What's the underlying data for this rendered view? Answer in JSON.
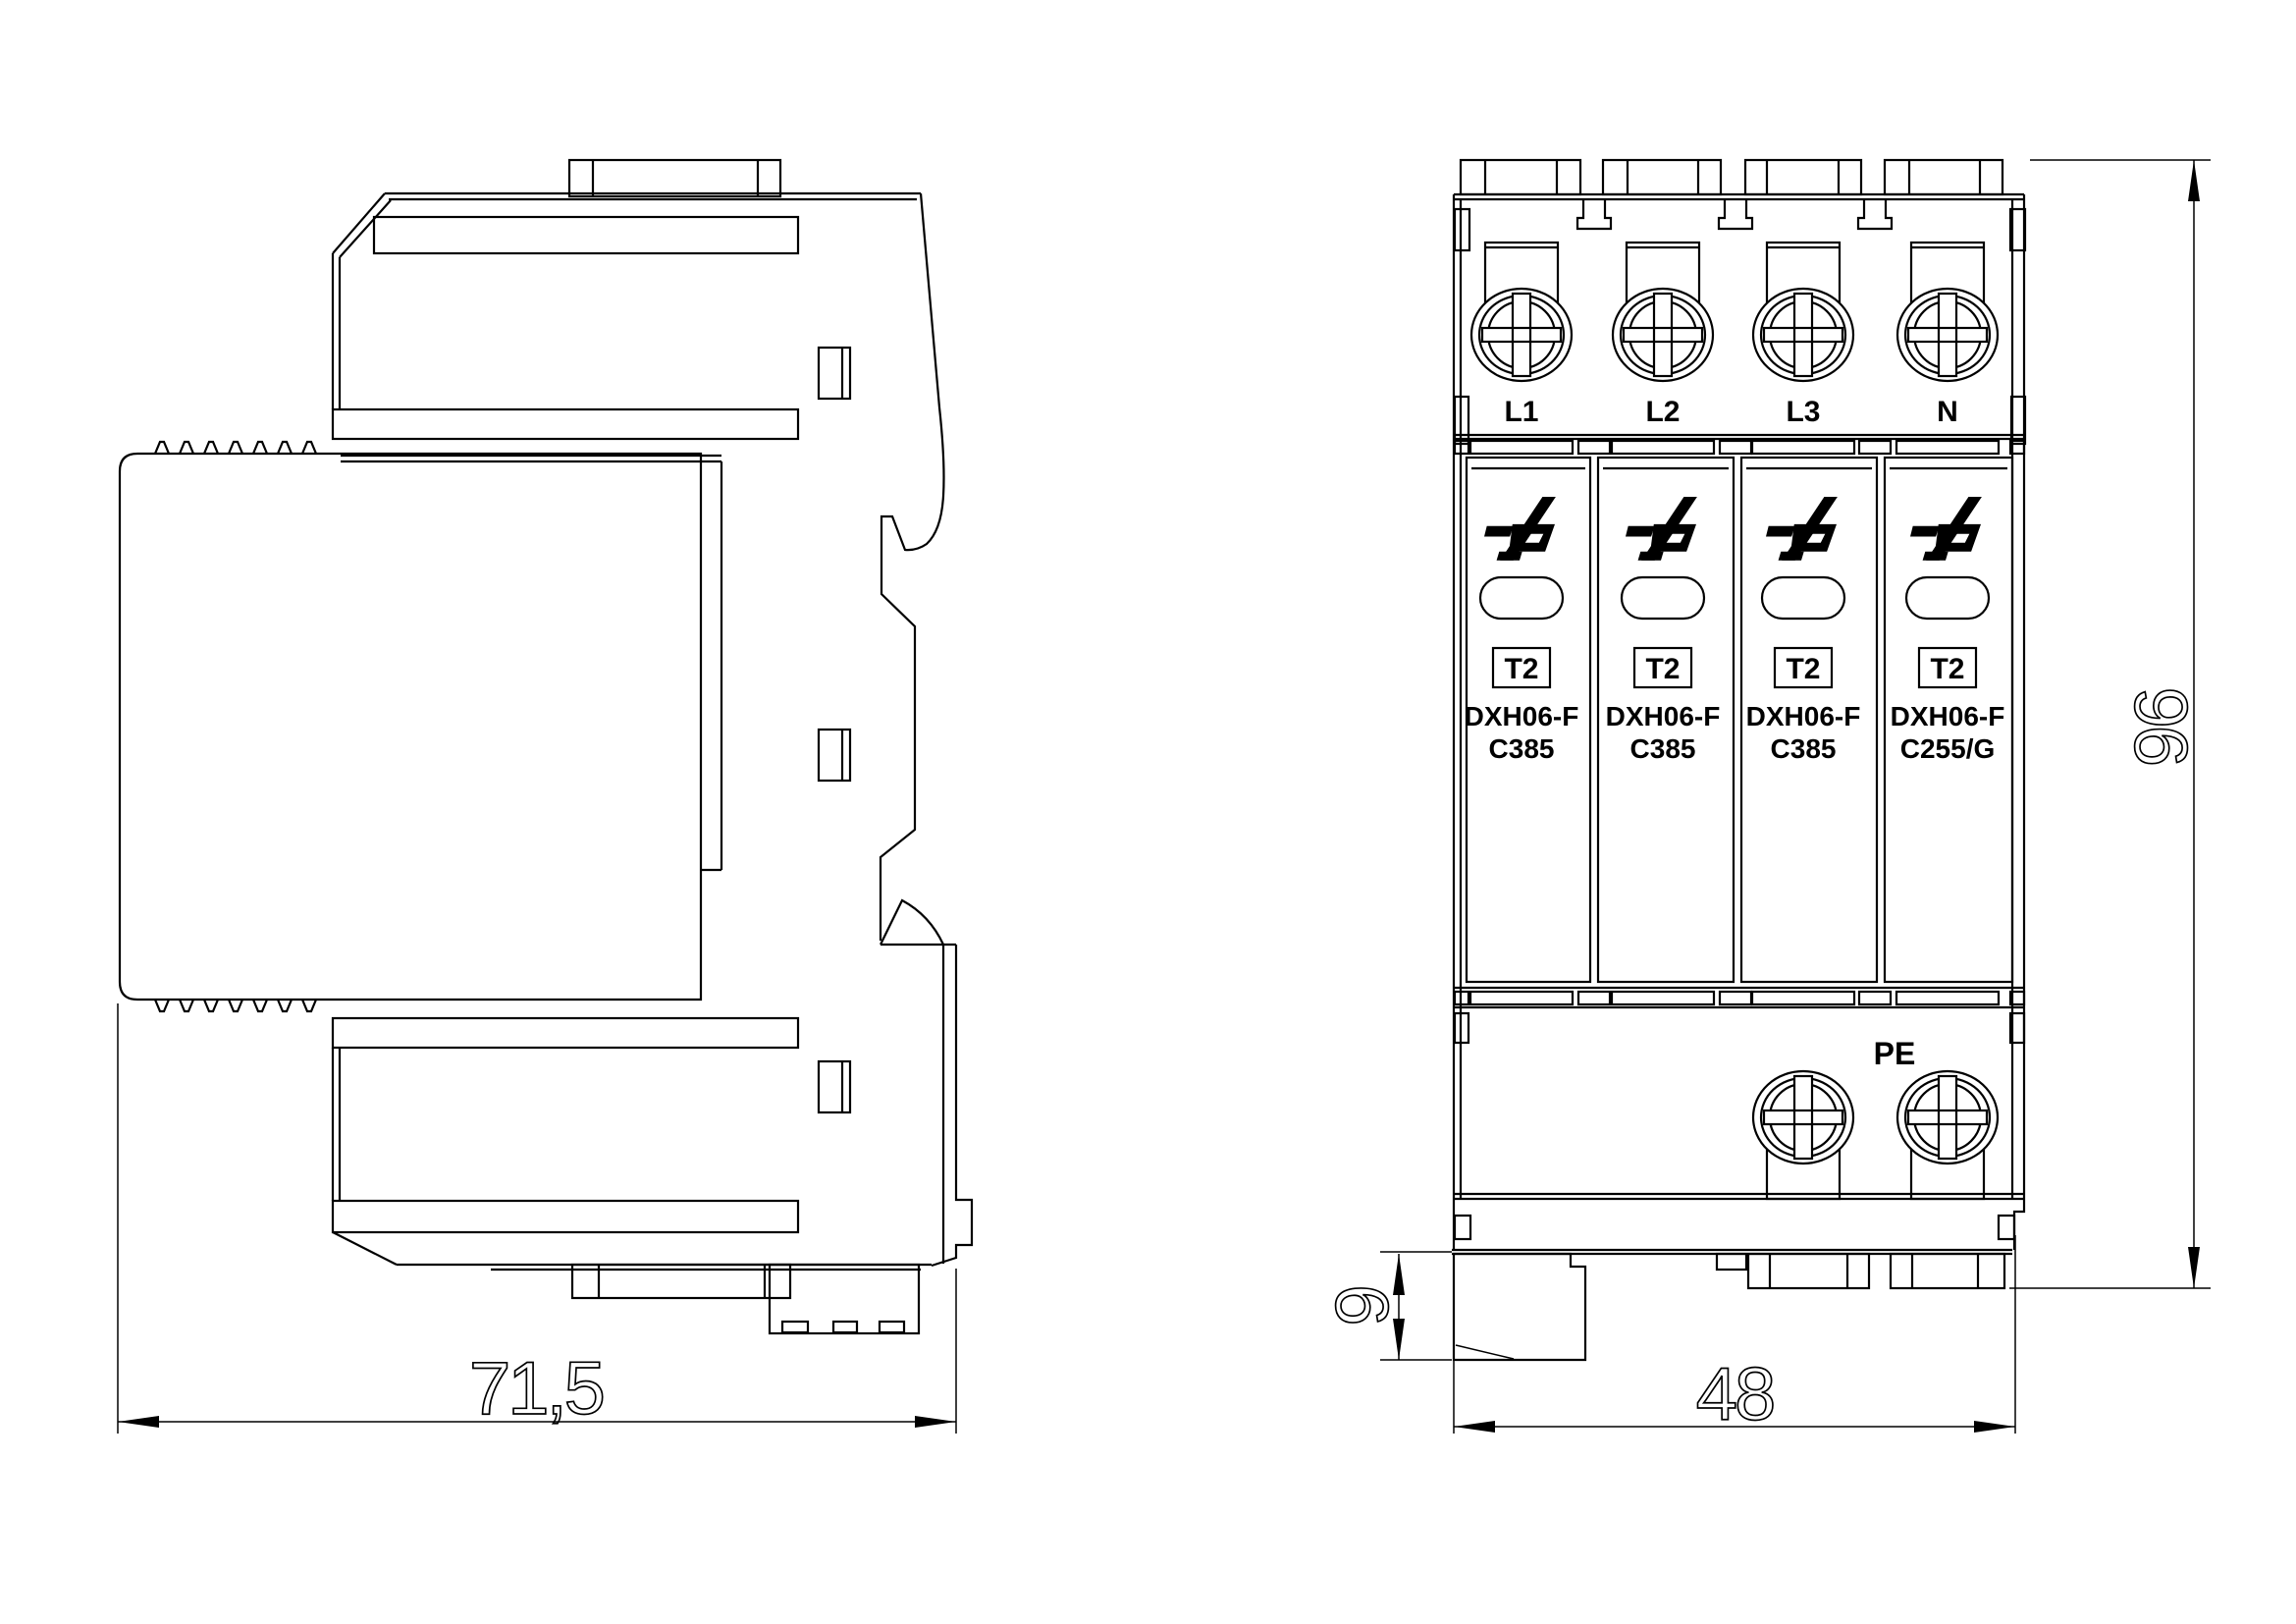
{
  "colors": {
    "line": "#000000",
    "background": "#ffffff"
  },
  "side_view": {
    "width_dim": "71,5"
  },
  "front_view": {
    "terminals": [
      "L1",
      "L2",
      "L3",
      "N"
    ],
    "ground_label": "PE",
    "modules": [
      {
        "type": "T2",
        "model": "DXH06-F",
        "code": "C385"
      },
      {
        "type": "T2",
        "model": "DXH06-F",
        "code": "C385"
      },
      {
        "type": "T2",
        "model": "DXH06-F",
        "code": "C385"
      },
      {
        "type": "T2",
        "model": "DXH06-F",
        "code": "C255/G"
      }
    ],
    "height_dim": "96",
    "width_dim": "48",
    "foot_dim": "9"
  },
  "icons": {
    "brand_logo": "double-lightning-brand-logo",
    "screw": "phillips-screw-terminal"
  }
}
